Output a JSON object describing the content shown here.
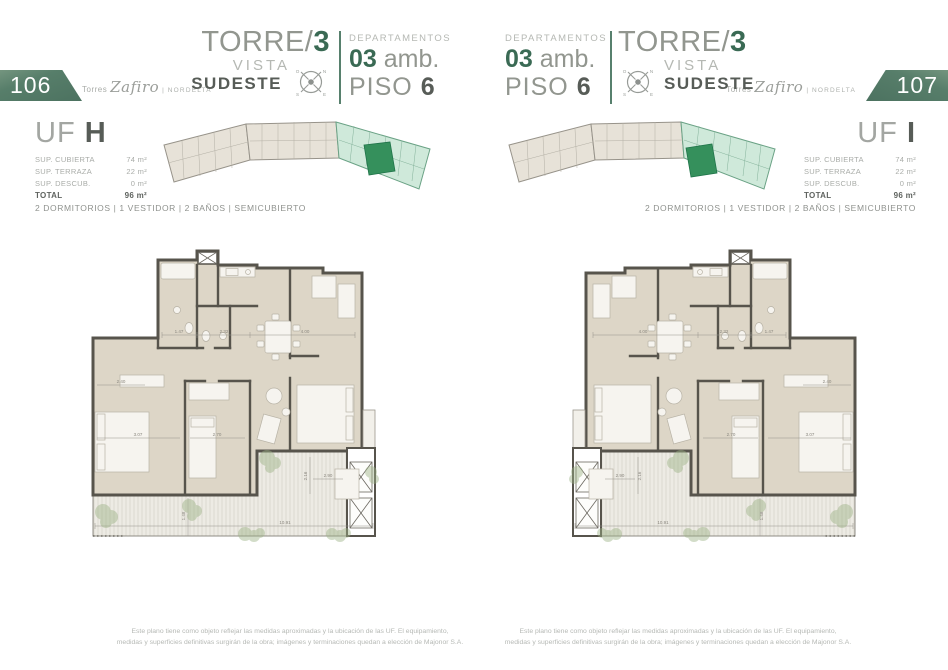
{
  "brand": {
    "prefix": "Torres",
    "name": "Zafiro",
    "sep": "|",
    "suffix": "NORDELTA"
  },
  "header": {
    "torre_prefix": "TORRE/",
    "torre_number": "3",
    "vista": "VISTA",
    "direction": "SUDESTE",
    "departamentos": "DEPARTAMENTOS",
    "amb_number": "03",
    "amb_suffix": " amb.",
    "piso_label": "PISO ",
    "piso_number": "6",
    "compass": {
      "o": "O",
      "n": "N",
      "s": "S",
      "e": "E"
    }
  },
  "pages": {
    "left": {
      "number": "106",
      "uf_label": "UF ",
      "uf_letter": "H"
    },
    "right": {
      "number": "107",
      "uf_label": "UF ",
      "uf_letter": "I"
    }
  },
  "unit": {
    "rows": [
      {
        "label": "SUP. CUBIERTA",
        "value": "74 m²"
      },
      {
        "label": "SUP. TERRAZA",
        "value": "22 m²"
      },
      {
        "label": "SUP. DESCUB.",
        "value": "0 m²"
      },
      {
        "label": "TOTAL",
        "value": "96 m²"
      }
    ],
    "program": "2 DORMITORIOS | 1 VESTIDOR | 2 BAÑOS | SEMICUBIERTO"
  },
  "plan_dims": {
    "d1": "1.47",
    "d2": "2.32",
    "d3": "4.00",
    "d4": "2.40",
    "d5": "3.07",
    "d6": "2.70",
    "d7": "2.90",
    "d8": "2.16",
    "d9": "10.91",
    "d10": "1.48"
  },
  "footer": {
    "line1": "Este plano tiene como objeto reflejar las medidas aproximadas y la ubicación de las UF. El equipamiento,",
    "line2": "medidas y superficies definitivas surgirán de la obra; imágenes y terminaciones quedan a elección de Majonor S.A."
  },
  "colors": {
    "badge_green": "#4c7260",
    "accent_green": "#3a6a54",
    "keyplan_green": "#cfe9da",
    "keyplan_unit_green": "#35905c",
    "wall": "#57544c",
    "room_fill": "#ddd6c7"
  }
}
